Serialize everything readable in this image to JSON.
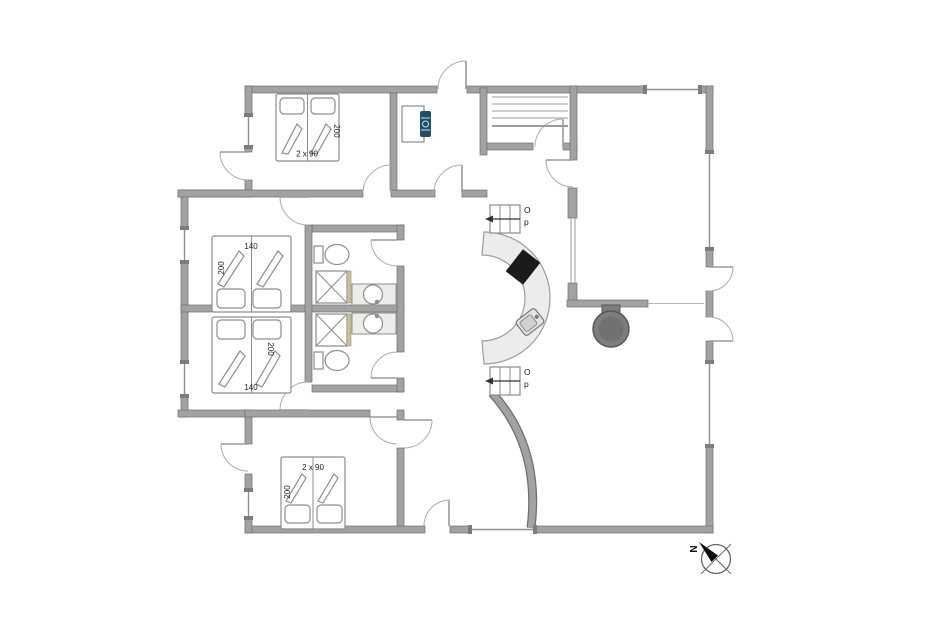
{
  "plan": {
    "bedrooms": {
      "northwest": {
        "bed_width": "2 x 90",
        "bed_length": "200"
      },
      "west_upper": {
        "bed_width": "140",
        "bed_length": "200"
      },
      "west_lower": {
        "bed_width": "140",
        "bed_length": "200"
      },
      "south": {
        "bed_width": "2 x 90",
        "bed_length": "200"
      }
    },
    "stairs": {
      "upper": {
        "label_line1": "O",
        "label_line2": "p"
      },
      "lower": {
        "label_line1": "O",
        "label_line2": "p"
      }
    },
    "compass": {
      "north_label": "N"
    }
  },
  "colors": {
    "wall_fill": "#a2a2a2",
    "wall_edge": "#6e6e6e",
    "fixture_line": "#8d8d8d",
    "counter_fill": "#ececea",
    "cooktop_fill": "#1b1b1b",
    "stove_fill": "#7d7d7d",
    "shower_trim": "#cdc28e",
    "boiler_accent": "#1d4f66",
    "label_text": "#1a1a1a"
  }
}
